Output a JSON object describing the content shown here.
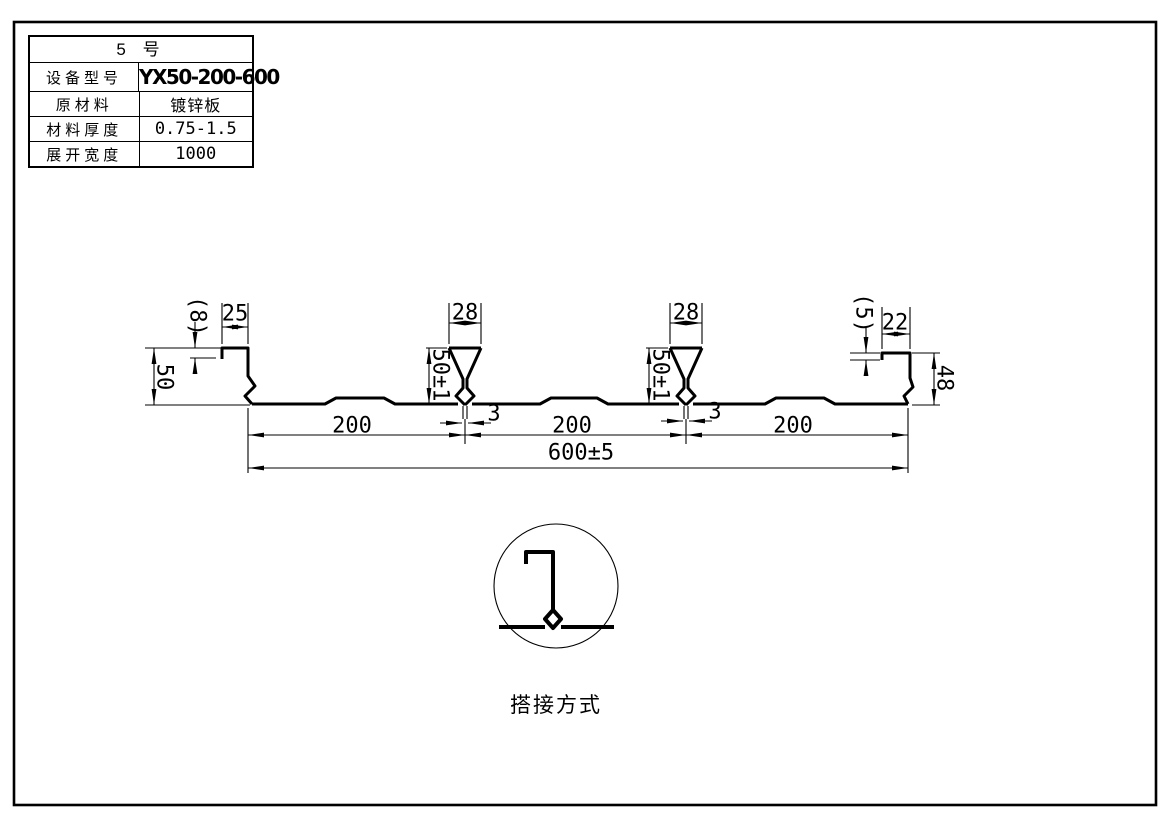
{
  "title_block": {
    "title": "5 号",
    "rows": [
      {
        "label": "设备型号",
        "value": "YX50-200-600"
      },
      {
        "label": "原材料",
        "value": "镀锌板"
      },
      {
        "label": "材料厚度",
        "value": "0.75-1.5"
      },
      {
        "label": "展开宽度",
        "value": "1000"
      }
    ]
  },
  "dimensions": {
    "left_lip_height": "(8)",
    "left_top_width": "25",
    "left_rib_height": "50",
    "rib1_top_width": "28",
    "rib1_height": "50±1",
    "rib1_stem_width": "3",
    "rib2_top_width": "28",
    "rib2_height": "50±1",
    "rib2_stem_width": "3",
    "right_lip_height": "(5)",
    "right_top_width": "22",
    "right_rib_height": "48",
    "pitch1": "200",
    "pitch2": "200",
    "pitch3": "200",
    "cover_width": "600±5"
  },
  "detail": {
    "caption": "搭接方式"
  },
  "colors": {
    "ink": "#000000",
    "paper": "#ffffff"
  }
}
